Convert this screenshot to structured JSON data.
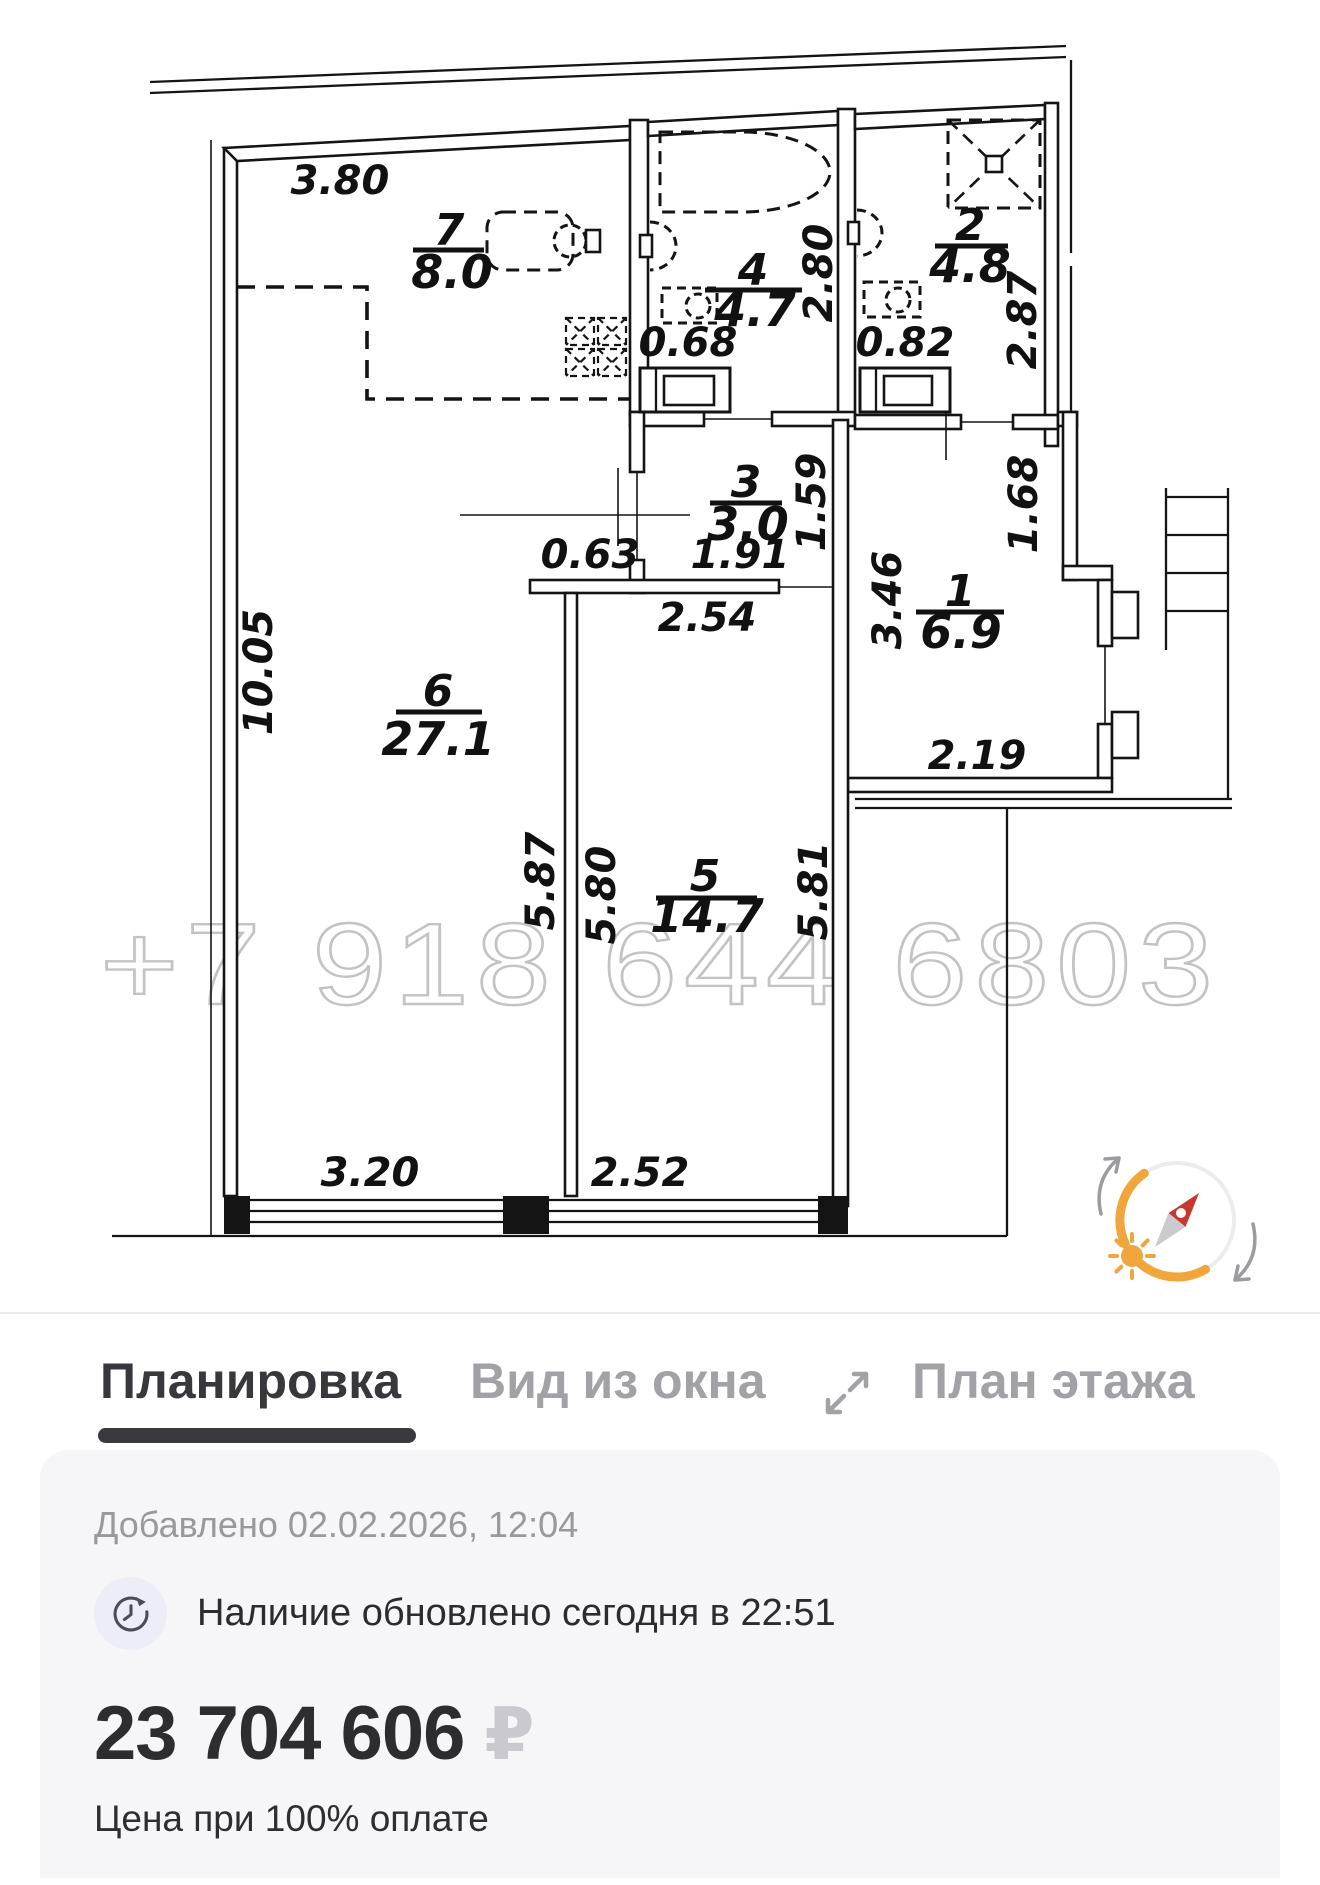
{
  "plan": {
    "watermark": "+7 918 644 6803",
    "rooms": {
      "r7": {
        "num": "7",
        "area": "8.0"
      },
      "r4": {
        "num": "4",
        "area": "4.7"
      },
      "r2": {
        "num": "2",
        "area": "4.8"
      },
      "r3": {
        "num": "3",
        "area": "3.0"
      },
      "r1": {
        "num": "1",
        "area": "6.9"
      },
      "r6": {
        "num": "6",
        "area": "27.1"
      },
      "r5": {
        "num": "5",
        "area": "14.7"
      }
    },
    "dims": {
      "d3_80": "3.80",
      "d0_68": "0.68",
      "d2_80": "2.80",
      "d0_82": "0.82",
      "d2_87": "2.87",
      "d1_59": "1.59",
      "d1_91": "1.91",
      "d0_63": "0.63",
      "d2_54": "2.54",
      "d3_46": "3.46",
      "d1_68": "1.68",
      "d2_19": "2.19",
      "d10_05": "10.05",
      "d5_87": "5.87",
      "d5_80": "5.80",
      "d5_81": "5.81",
      "d3_20": "3.20",
      "d2_52": "2.52"
    }
  },
  "tabs": {
    "layout": "Планировка",
    "window_view": "Вид из окна",
    "floor_plan": "План этажа"
  },
  "info": {
    "added": "Добавлено 02.02.2026, 12:04",
    "availability": "Наличие обновлено сегодня в 22:51",
    "price": "23 704 606",
    "currency": "₽",
    "price_note": "Цена при 100% оплате"
  },
  "colors": {
    "accent_orange": "#F0A63C",
    "needle_red": "#C8362F",
    "tab_active": "#38383C",
    "tab_inactive": "#A2A2A6",
    "card_bg": "#F6F6F8",
    "watermark_gray": "#C3C3C6"
  }
}
